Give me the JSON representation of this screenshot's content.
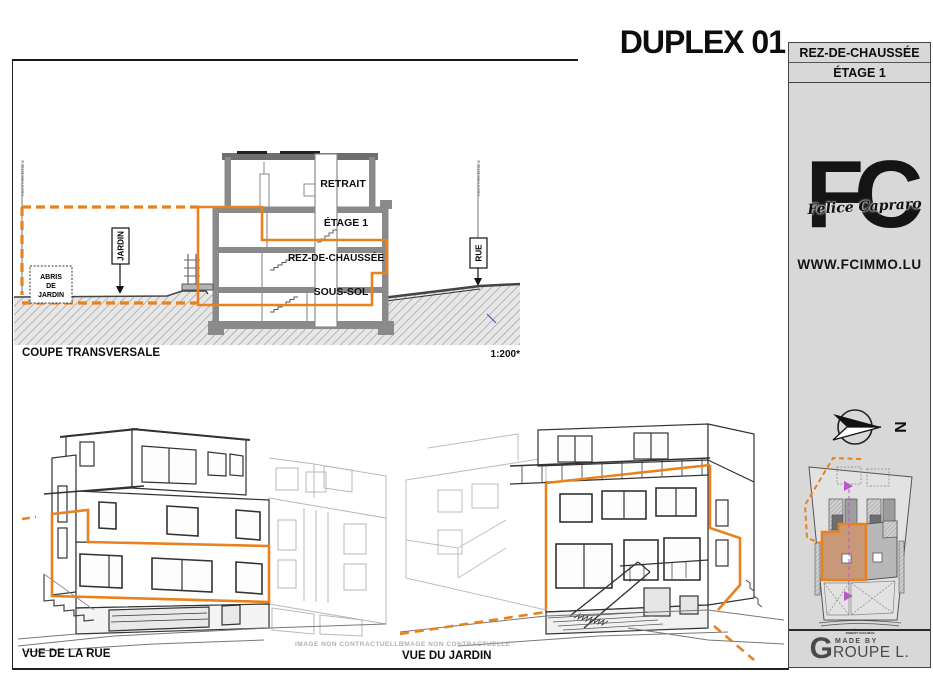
{
  "page": {
    "title": "DUPLEX 01",
    "subtitle": "25 BOULEVARD ROBERT SCHUMAN - OLM"
  },
  "sidebar": {
    "floor_labels": [
      "REZ-DE-CHAUSSÉE",
      "ÉTAGE 1"
    ],
    "logo": {
      "initials": "FC",
      "script": "Felice Capraro",
      "website": "WWW.FCIMMO.LU"
    },
    "compass_north": "N",
    "site_plan": {
      "street_line1": "Boulevard",
      "street_line2": "ROBERT SCHUMAN"
    },
    "made_by": {
      "prefix": "MADE BY",
      "brand_initial": "G",
      "brand_rest": "ROUPE L."
    }
  },
  "section": {
    "caption": "COUPE TRANSVERSALE",
    "scale": "1:200*",
    "floors": [
      "RETRAIT",
      "ÉTAGE 1",
      "REZ-DE-CHAUSSÉE",
      "SOUS-SOL"
    ],
    "garden_label": "JARDIN",
    "street_label": "RUE",
    "shed_lines": [
      "ABRIS",
      "DE",
      "JARDIN"
    ],
    "boundary_label": "LIMITE PARCELLAIRE"
  },
  "views": {
    "street": {
      "caption": "VUE DE LA RUE",
      "watermark": "IMAGE NON CONTRACTUELLE"
    },
    "garden": {
      "caption": "VUE DU JARDIN",
      "watermark": "IMAGE NON CONTRACTUELLE"
    }
  },
  "colors": {
    "accent_orange": "#E8821E",
    "unit_highlight_tan": "#C99878",
    "sidebar_gray": "#D8D8D8",
    "wall_gray": "#8A8A8A",
    "arrow_magenta": "#BB55CC",
    "mark_blue": "#4455CC"
  }
}
